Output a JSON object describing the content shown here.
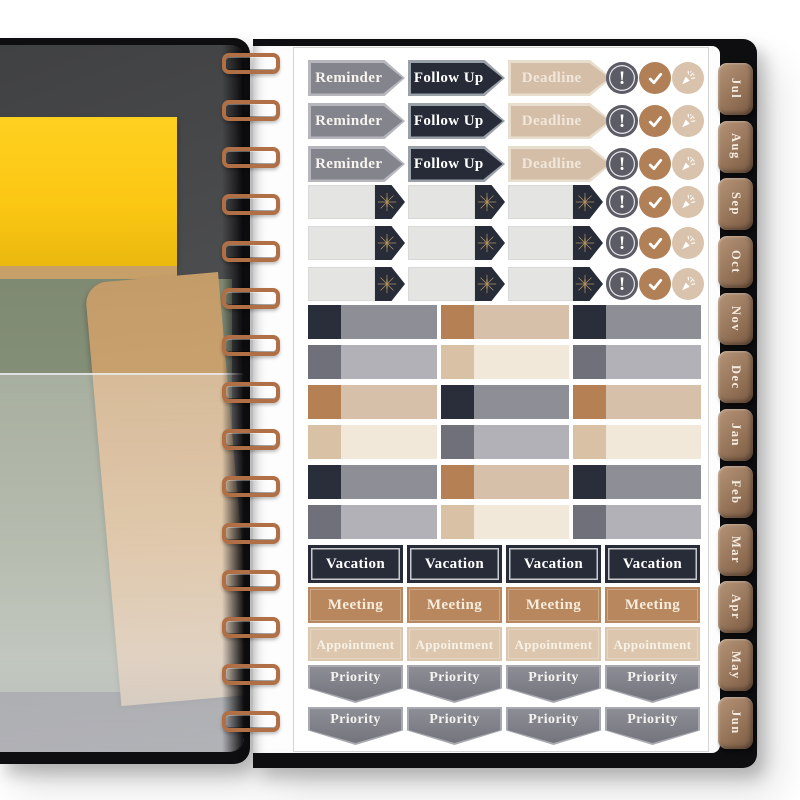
{
  "product": {
    "description": "Open spiral-bound planner showing inside-cover pocket page (left) and a planner sticker sheet page (right) with monthly edge tabs"
  },
  "sticker_sheet": {
    "arrow_rows": [
      {
        "labels": [
          "Reminder",
          "Follow Up",
          "Deadline"
        ]
      },
      {
        "labels": [
          "Reminder",
          "Follow Up",
          "Deadline"
        ]
      },
      {
        "labels": [
          "Reminder",
          "Follow Up",
          "Deadline"
        ]
      }
    ],
    "blank_arrow_row_count": 3,
    "badge_icons": [
      {
        "name": "exclamation-icon",
        "glyph": "!"
      },
      {
        "name": "check-icon"
      },
      {
        "name": "party-popper-icon"
      }
    ],
    "bar_rows": [
      [
        "navy",
        "brown",
        "navy"
      ],
      [
        "gray",
        "tan",
        "gray"
      ],
      [
        "brown",
        "navy",
        "brown"
      ],
      [
        "tan",
        "gray",
        "tan"
      ],
      [
        "navy",
        "brown",
        "navy"
      ],
      [
        "gray",
        "tan",
        "gray"
      ]
    ],
    "label_rows": [
      {
        "label": "Vacation",
        "style": "vacation",
        "count": 4
      },
      {
        "label": "Meeting",
        "style": "meeting",
        "count": 4
      },
      {
        "label": "Appointment",
        "style": "appointment",
        "count": 4
      },
      {
        "label": "Priority",
        "style": "priority",
        "count": 4
      },
      {
        "label": "Priority",
        "style": "priority",
        "count": 4
      }
    ]
  },
  "tabs": {
    "months": [
      "Jul",
      "Aug",
      "Sep",
      "Oct",
      "Nov",
      "Dec",
      "Jan",
      "Feb",
      "Mar",
      "Apr",
      "May",
      "Jun"
    ]
  },
  "colors": {
    "cover_black": "#0e0e10",
    "copper": "#b06f45",
    "page_dark_a": "#404143",
    "page_dark_b": "#646568",
    "yellow_paper": "#fbc713",
    "kraft": "#c79f68",
    "green_folder": "#87927b",
    "tab_light": "#b59377",
    "tab_dark": "#7a5a42",
    "tab_text": "#f3ecdf",
    "sheet_border": "#d4d4d2",
    "schemes": {
      "reminder": {
        "bg": "#84848c",
        "border": "#b6b6bc",
        "text": "#f7f4ef"
      },
      "followup": {
        "bg": "#262b37",
        "border": "#9aa0a8",
        "text": "#ffffff"
      },
      "deadline": {
        "bg": "#d4bea8",
        "border": "#e8decd",
        "text": "#f0e7da"
      },
      "blank_body": {
        "bg": "#e4e4e2",
        "border": "#d9d9d7"
      },
      "head_navy": "#272c38",
      "starburst": "#b2925f",
      "badge_alert": "#5c5c67",
      "badge_check": "#b28057",
      "badge_party": "#d9c3ad",
      "bar_navy": {
        "head": "#2a2e3a",
        "body": "#8e8e96"
      },
      "bar_gray": {
        "head": "#70707b",
        "body": "#b1b1b7"
      },
      "bar_brown": {
        "head": "#b58154",
        "body": "#d6c0aa"
      },
      "bar_tan": {
        "head": "#d9c1a6",
        "body": "#f2e8da"
      },
      "vacation": {
        "bg": "#272c38",
        "text": "#ffffff"
      },
      "meeting": {
        "bg": "#b8875d",
        "text": "#f5ecdd"
      },
      "appointment": {
        "bg": "#dcc6ae",
        "text": "#f8f1e5"
      },
      "priority": {
        "bg1": "#8d8d96",
        "bg2": "#74747d",
        "border": "#a9a9b1",
        "text": "#f5f3ef"
      }
    }
  }
}
